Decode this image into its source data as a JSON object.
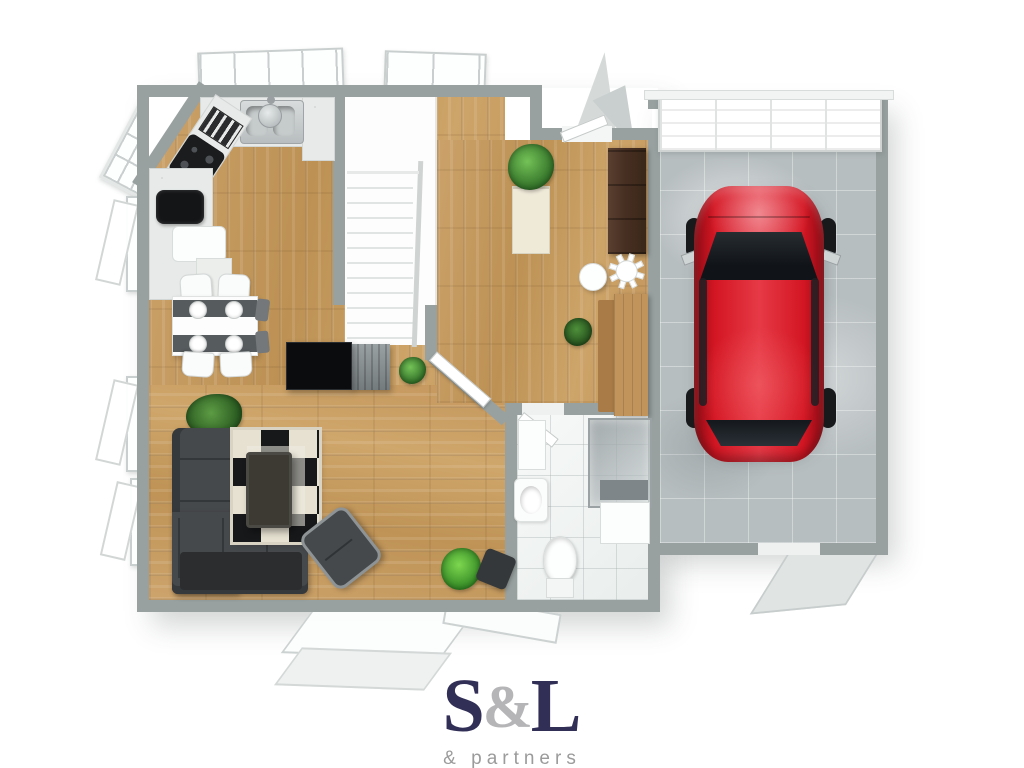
{
  "brand": {
    "wordmark_s": "S",
    "wordmark_amp": "&",
    "wordmark_l": "L",
    "tagline": "& partners"
  },
  "palette": {
    "wall": "#98a1a0",
    "wall-light": "#c3c9c8",
    "counter": "#e7eae8",
    "concrete": "#b7bec0",
    "tile": "#f3f5f4",
    "sofa": "#46494c",
    "sofa-dark": "#2b2d2f",
    "rug-sand": "#e6e1d1",
    "rug-black": "#17181a",
    "table-dark": "#3c3a33",
    "wood-furniture": "#483023",
    "desk-wood": "#c1945c",
    "car-red": "#cf1420",
    "car-red-dark": "#8e0c15",
    "glass-dark": "#15191d",
    "steel": "#c0c6c8",
    "plant-green": "#3f7a33",
    "plant-bright": "#54c23a",
    "logo-navy": "#322f57",
    "logo-gray": "#b5b5b8",
    "tagline-gray": "#9b9b9b"
  }
}
